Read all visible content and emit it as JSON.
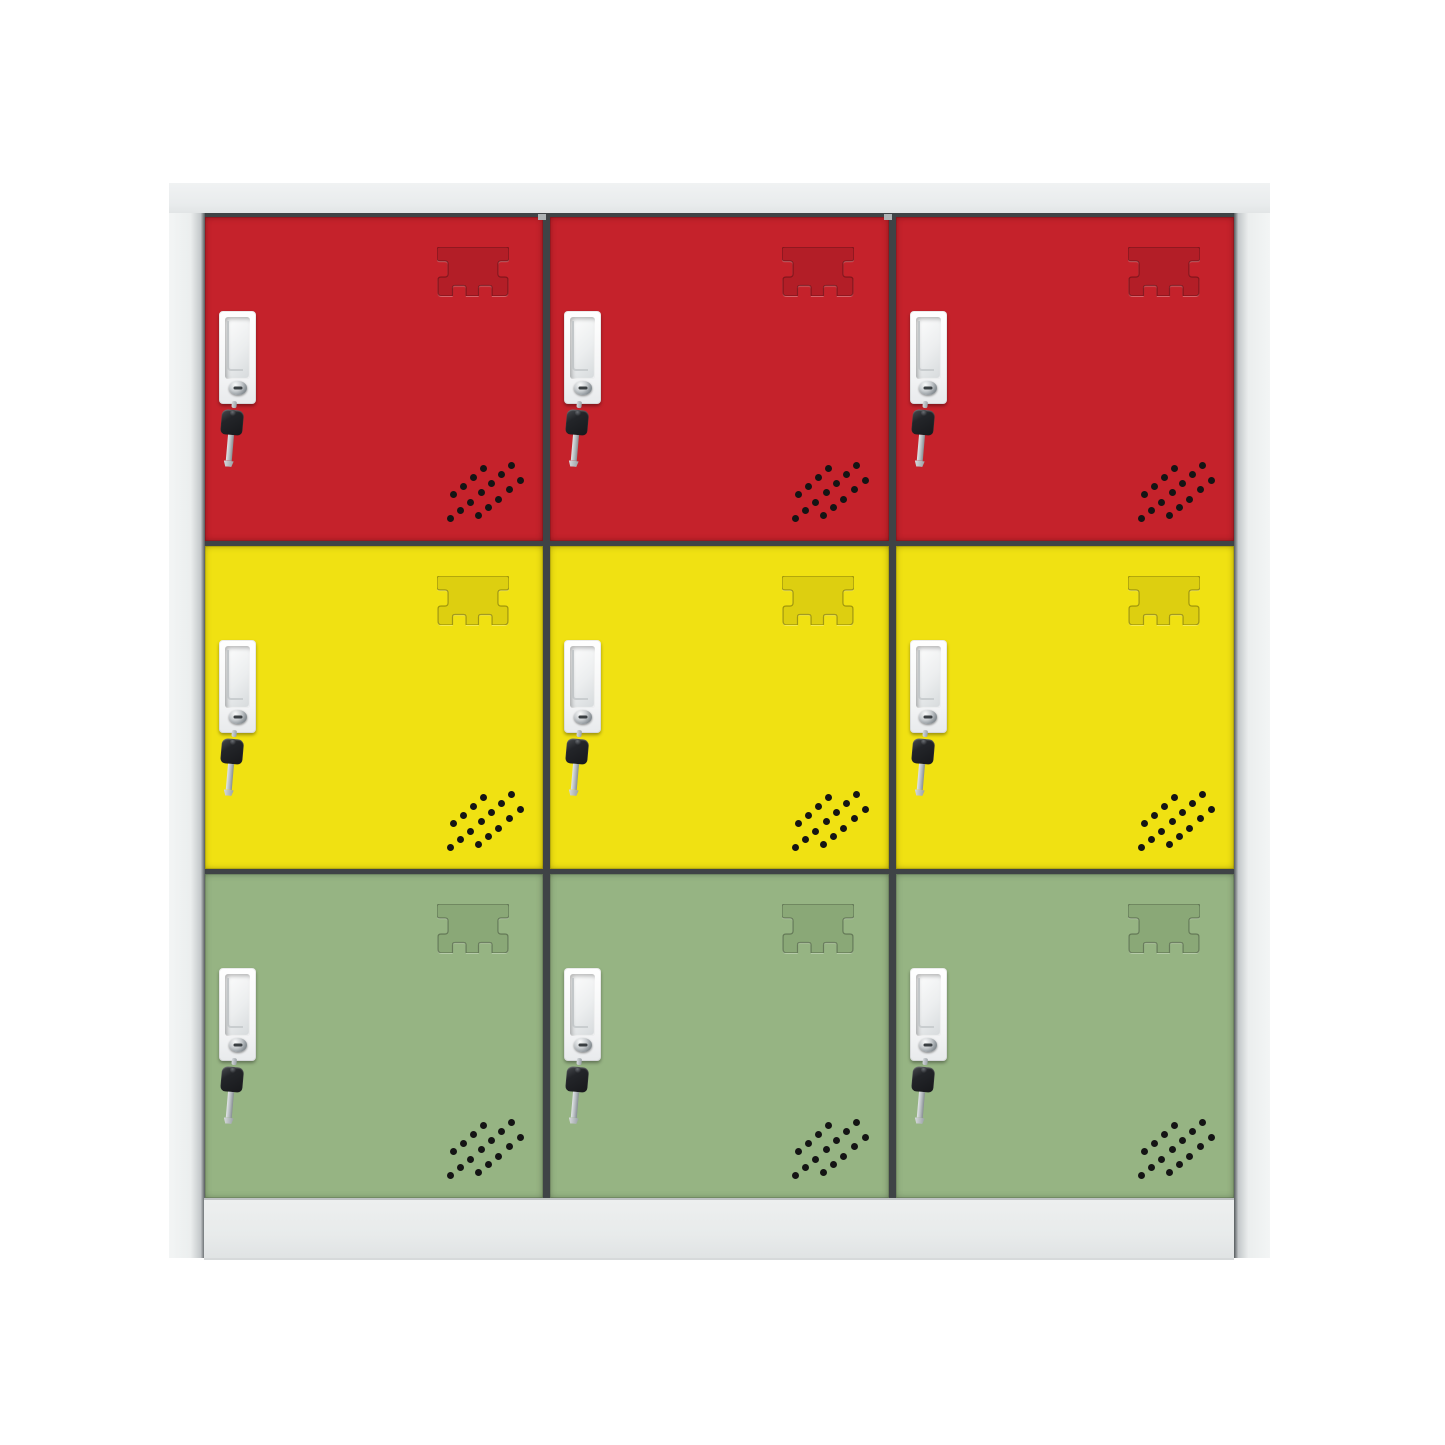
{
  "meta": {
    "description": "Product photo of a nine-compartment metal locker cabinet on a white background",
    "background_color": "#ffffff"
  },
  "cabinet": {
    "kind": "nine-door-locker-cabinet",
    "columns": 3,
    "frame": {
      "body_color": "#eceeef",
      "cap_edge_color": "#c9cdcf",
      "gap_color": "#3f4346",
      "plinth_color": "#e9ebec"
    },
    "hardware": {
      "handle_color": "#f7f8f9",
      "lock_cylinder_color": "#c9cdd0",
      "key_head_color": "#1f2124",
      "key_shaft_color": "#b4babe",
      "vent_dot_color": "#141414"
    },
    "rows": [
      {
        "label": "top",
        "door_color": "#c5222b",
        "stamp_color": "#b31e27"
      },
      {
        "label": "middle",
        "door_color": "#f0e112",
        "stamp_color": "#ddcf10"
      },
      {
        "label": "bottom",
        "door_color": "#96b483",
        "stamp_color": "#8aa877"
      }
    ],
    "lockers": [
      {
        "position": "top-left",
        "row": 0
      },
      {
        "position": "top-center",
        "row": 0
      },
      {
        "position": "top-right",
        "row": 0
      },
      {
        "position": "middle-left",
        "row": 1
      },
      {
        "position": "middle-center",
        "row": 1
      },
      {
        "position": "middle-right",
        "row": 1
      },
      {
        "position": "bottom-left",
        "row": 2
      },
      {
        "position": "bottom-center",
        "row": 2
      },
      {
        "position": "bottom-right",
        "row": 2
      }
    ]
  }
}
